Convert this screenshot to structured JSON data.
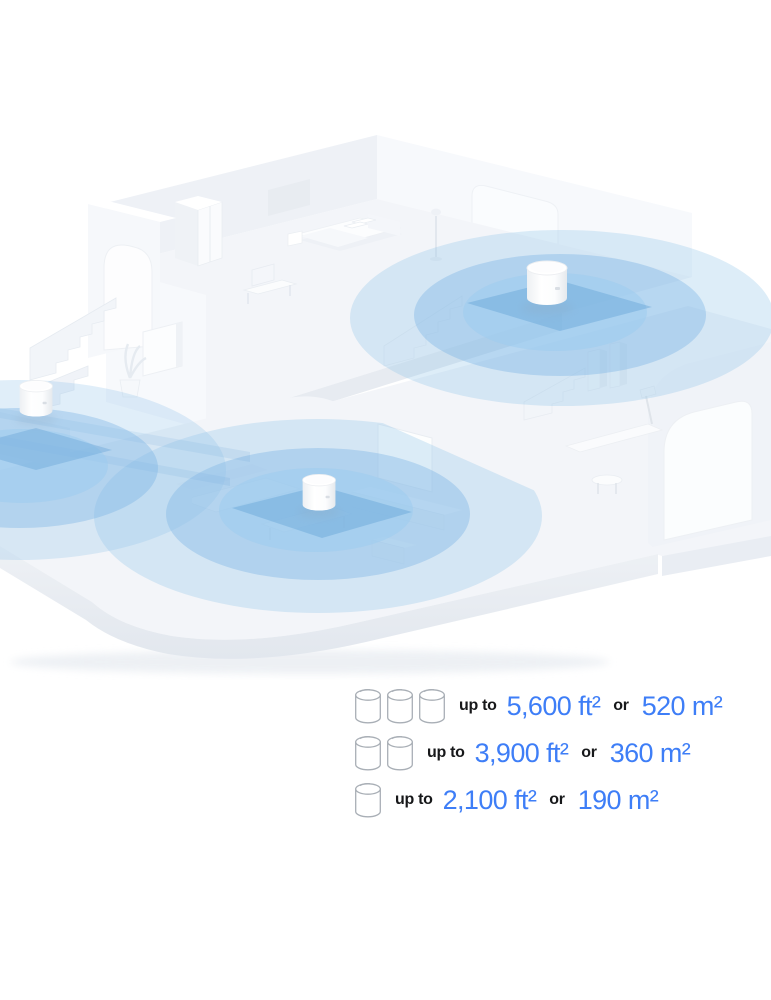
{
  "illustration": {
    "description": "Isometric cutaway two-level home with three mesh Wi-Fi units broadcasting blue coverage circles",
    "unit_count_in_scene": 3,
    "units": [
      {
        "name": "deco-unit-upper-floor"
      },
      {
        "name": "deco-unit-left-ledge"
      },
      {
        "name": "deco-unit-living-room"
      }
    ],
    "colors": {
      "coverage_blue_outer": "#8fc2e9",
      "coverage_blue_mid": "#79b4e4",
      "coverage_blue_inner": "#9cccef",
      "coverage_patch": "#5f9fd4",
      "house_wall_light": "#f7f9fc",
      "house_wall_mid": "#eef1f6",
      "house_floor": "#f3f5f9",
      "house_edge": "#e7ebf1"
    }
  },
  "legend": {
    "rows": [
      {
        "unit_count": 3,
        "prefix": "up to",
        "area_imperial": "5,600 ft²",
        "conjunction": "or",
        "area_metric": "520 m²"
      },
      {
        "unit_count": 2,
        "prefix": "up to",
        "area_imperial": "3,900 ft²",
        "conjunction": "or",
        "area_metric": "360 m²"
      },
      {
        "unit_count": 1,
        "prefix": "up to",
        "area_imperial": "2,100 ft²",
        "conjunction": "or",
        "area_metric": "190 m²"
      }
    ],
    "colors": {
      "value_blue": "#3e7ef7",
      "label_dark": "#17181a",
      "icon_outline": "#a9afb6"
    }
  }
}
